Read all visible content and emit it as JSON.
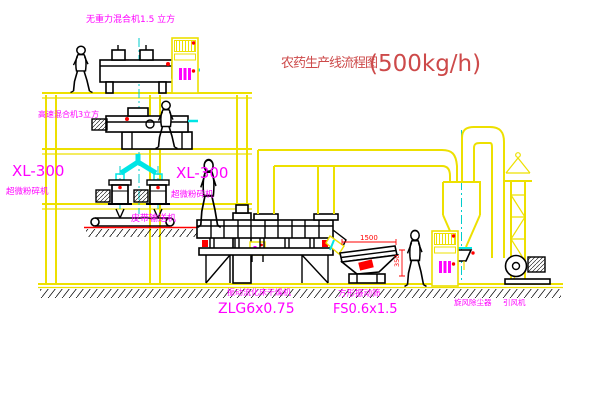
{
  "title": {
    "name": "农药生产线流程图",
    "capacity": "(500kg/h)"
  },
  "equipment": {
    "gravity_mixer": {
      "label": "无重力混合机1.5 立方"
    },
    "high_speed_mixer": {
      "label": "高速混合机3立方"
    },
    "mill_left": {
      "model": "XL-300",
      "label": "超微粉碎机"
    },
    "mill_right": {
      "model": "XL-300",
      "label": "超微粉碎机"
    },
    "belt_conveyor": {
      "label": "皮带输送机"
    },
    "dryer": {
      "label": "振动流化床干燥机",
      "model": "ZLG6x0.75"
    },
    "screen": {
      "label": "方形振动筛",
      "model": "FS0.6x1.5"
    },
    "cyclone": {
      "label": "旋风除尘器"
    },
    "fan": {
      "label": "引风机"
    }
  },
  "dimensions": {
    "screen_length": "1500",
    "screen_outlet_height": "350"
  },
  "colors": {
    "frame_yellow": "#ede000",
    "label_magenta": "#ff00ff",
    "title_red": "#cd4a4a",
    "dimension_red": "#ff0000",
    "chute_cyan": "#00e5e5",
    "equipment_black": "#000000"
  }
}
